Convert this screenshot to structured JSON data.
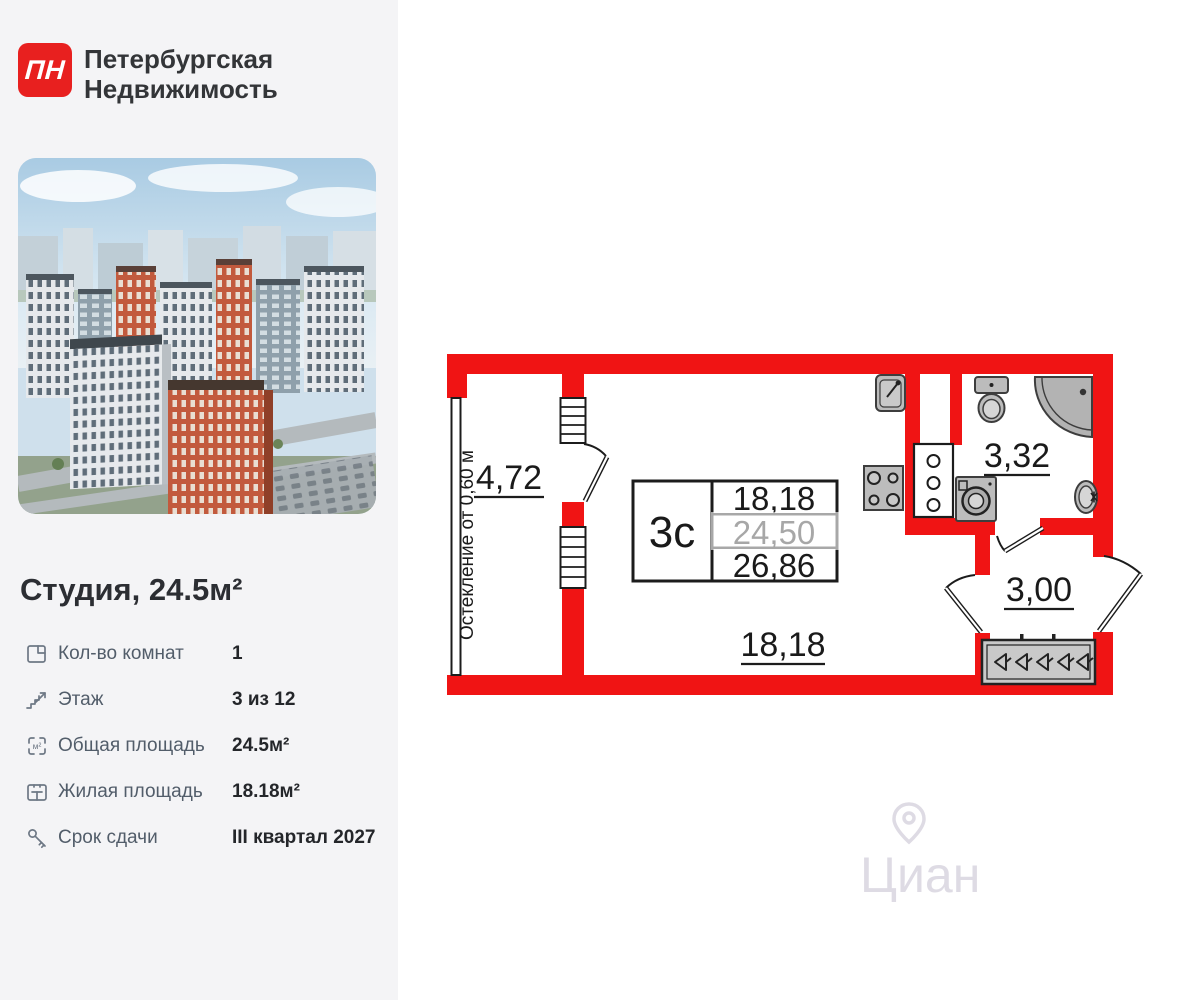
{
  "brand": {
    "logo_text": "ПН",
    "name_line1": "Петербургская",
    "name_line2": "Недвижимость"
  },
  "listing": {
    "title": "Студия, 24.5м²",
    "details": [
      {
        "icon": "room-plan-icon",
        "label": "Кол-во комнат",
        "value": "1"
      },
      {
        "icon": "stairs-icon",
        "label": "Этаж",
        "value": "3 из 12"
      },
      {
        "icon": "total-area-icon",
        "label": "Общая площадь",
        "value": "24.5м²"
      },
      {
        "icon": "living-area-icon",
        "label": "Жилая площадь",
        "value": "18.18м²"
      },
      {
        "icon": "key-icon",
        "label": "Срок сдачи",
        "value": "III квартал 2027"
      }
    ]
  },
  "floorplan": {
    "glazing_note": "Остекление от 0,60 м",
    "areas": {
      "balcony": "4,72",
      "bathroom": "3,32",
      "hallway": "3,00",
      "main_room": "18,18"
    },
    "area_table": {
      "type_label": "3с",
      "living_area": "18,18",
      "total_area": "24,50",
      "total_with_balcony": "26,86"
    },
    "wall_color": "#f01414"
  },
  "watermark": {
    "text": "Циан"
  }
}
